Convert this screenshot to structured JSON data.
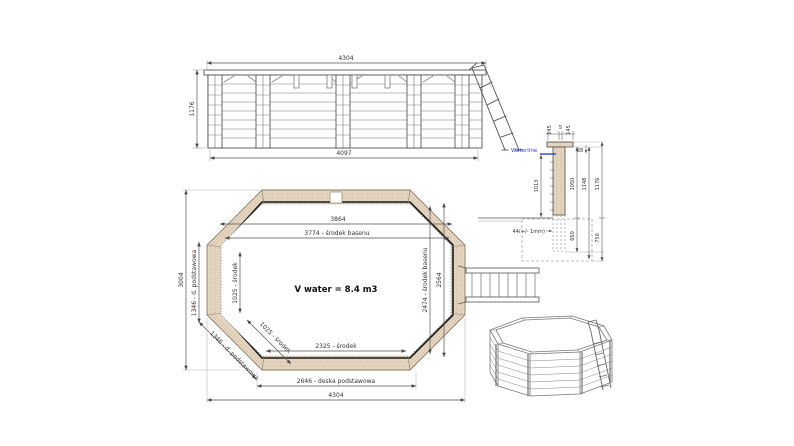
{
  "drawing_title": "Octagonal wooden pool technical drawing",
  "colors": {
    "wood": "#e3d4c0",
    "wood_dark": "#b09878",
    "line": "#555555",
    "dark_ring": "#1a1a1a",
    "waterline_blue": "#2b3fd0"
  },
  "elevation": {
    "width_top": "4304",
    "height_left": "1176",
    "width_bottom": "4097"
  },
  "plan": {
    "width_inner": "3864",
    "width_center": "3774 - środek basenu",
    "height_overall": "3004",
    "board_left": "1346 - d. podstawowa",
    "center_left": "1025 - środek",
    "center_diag": "1025 - środek",
    "board_diag": "1346 - d. podstawowa",
    "center_right": "2474 - środek basenu",
    "height_right": "2564",
    "center_bottom": "2325 - środek",
    "board_bottom": "2646 - deska podstawowa",
    "width_overall": "4304",
    "volume": "V water = 8.4 m3"
  },
  "section": {
    "waterline": "Waterline",
    "cap_left": "145",
    "cap_gap": "5",
    "cap_right": "145",
    "cap_thickness": "28",
    "water_depth": "1013",
    "wall_inner_height": "1050",
    "wall_outer_height": "1148",
    "total_height": "1176",
    "wall_thickness": "44(+/- 1mm)",
    "below_ground": "650",
    "foundation_depth": "750"
  }
}
